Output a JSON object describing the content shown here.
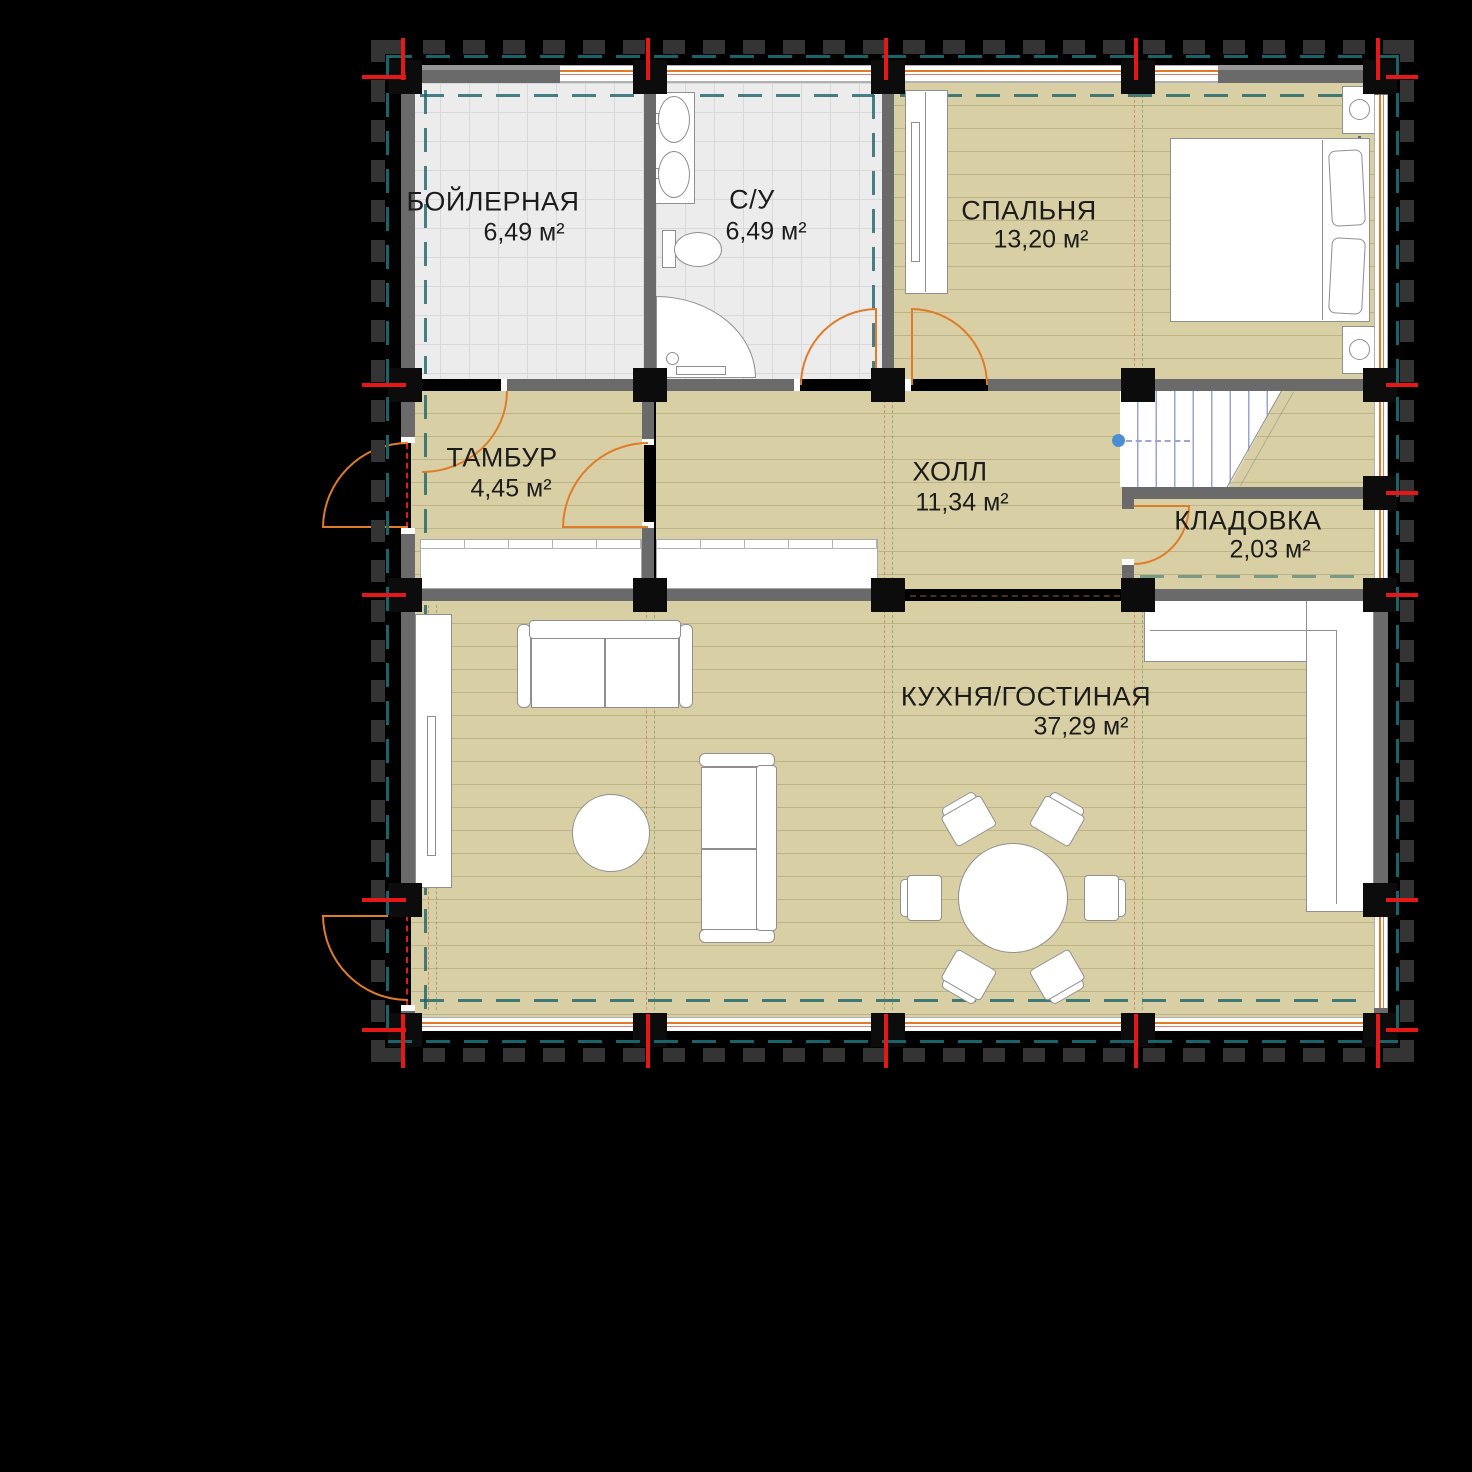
{
  "plan": {
    "kind": "architectural floor plan"
  },
  "colors": {
    "background": "#000000",
    "floor_wood": "#d8d0a4",
    "floor_tile": "#ececec",
    "tile_line": "#d9d9d9",
    "wall": "#6a6a6a",
    "column": "#0c0c0c",
    "furniture_fill": "#ffffff",
    "furniture_line": "#8f8f8f",
    "axis_red": "#e51717",
    "door_orange": "#e07b28",
    "teal_dash": "#19646a",
    "stair_blue": "#9aa5d2",
    "stair_dot_blue": "#4a8fd4",
    "label_text": "#1c1c1c"
  },
  "rooms": [
    {
      "name": "БОЙЛЕРНАЯ",
      "area": "6,49 м²"
    },
    {
      "name": "С/У",
      "area": "6,49 м²"
    },
    {
      "name": "СПАЛЬНЯ",
      "area": "13,20 м²"
    },
    {
      "name": "ТАМБУР",
      "area": "4,45 м²"
    },
    {
      "name": "ХОЛЛ",
      "area": "11,34 м²"
    },
    {
      "name": "КЛАДОВКА",
      "area": "2,03 м²"
    },
    {
      "name": "КУХНЯ/ГОСТИНАЯ",
      "area": "37,29 м²"
    }
  ]
}
